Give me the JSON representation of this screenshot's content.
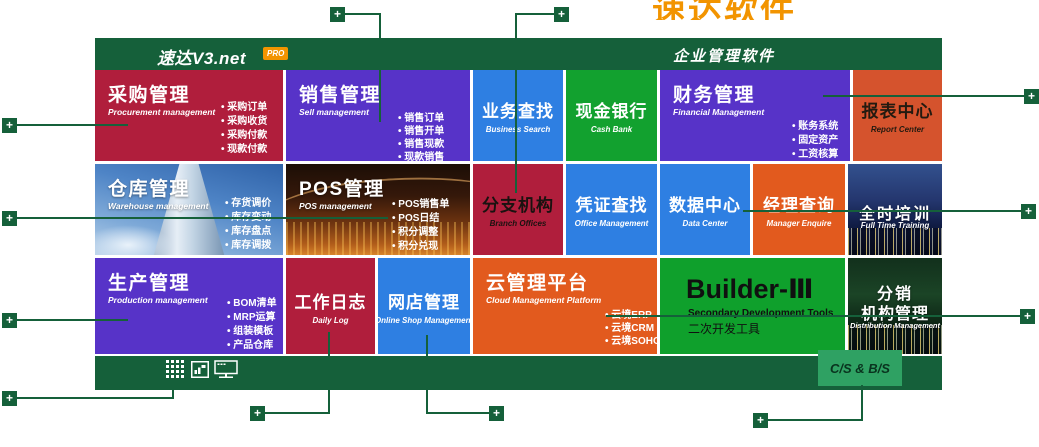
{
  "banner": {
    "cropped_text": "速达软件"
  },
  "header": {
    "brand": "速达V3.net",
    "pro_badge": "PRO",
    "product_title": "企业管理软件"
  },
  "tiles": {
    "procurement": {
      "title": "采购管理",
      "subtitle": "Procurement management",
      "items": [
        "采购订单",
        "采购收货",
        "采购付款",
        "现款付款"
      ]
    },
    "sell": {
      "title": "销售管理",
      "subtitle": "Sell management",
      "items": [
        "销售订单",
        "销售开单",
        "销售现款",
        "现款销售"
      ]
    },
    "business_search": {
      "title": "业务查找",
      "subtitle": "Business Search"
    },
    "cash_bank": {
      "title": "现金银行",
      "subtitle": "Cash Bank"
    },
    "financial": {
      "title": "财务管理",
      "subtitle": "Financial Management",
      "items": [
        "账务系统",
        "固定资产",
        "工资核算"
      ]
    },
    "report_center": {
      "title": "报表中心",
      "subtitle": "Report Center"
    },
    "warehouse": {
      "title": "仓库管理",
      "subtitle": "Warehouse management",
      "items": [
        "存货调价",
        "库存变动",
        "库存盘点",
        "库存调拨"
      ]
    },
    "pos": {
      "title": "POS管理",
      "subtitle": "POS management",
      "items": [
        "POS销售单",
        "POS日结",
        "积分调整",
        "积分兑现"
      ]
    },
    "branch": {
      "title": "分支机构",
      "subtitle": "Branch Offices"
    },
    "voucher": {
      "title": "凭证查找",
      "subtitle": "Office Management"
    },
    "data_center": {
      "title": "数据中心",
      "subtitle": "Data Center"
    },
    "manager": {
      "title": "经理查询",
      "subtitle": "Manager Enquire"
    },
    "training": {
      "title": "全时培训",
      "subtitle": "Full Time Training"
    },
    "production": {
      "title": "生产管理",
      "subtitle": "Production management",
      "items": [
        "BOM清单",
        "MRP运算",
        "组装模板",
        "产品仓库"
      ]
    },
    "daily_log": {
      "title": "工作日志",
      "subtitle": "Daily Log"
    },
    "online_shop": {
      "title": "网店管理",
      "subtitle": "Online Shop Management"
    },
    "cloud": {
      "title": "云管理平台",
      "subtitle": "Cloud Management Platform",
      "items": [
        "云境ERP",
        "云境CRM",
        "云境SOHO"
      ]
    },
    "builder": {
      "title": "Builder-Ⅲ",
      "subtitle": "Secondary Development Tools",
      "subtitle_cn": "二次开发工具"
    },
    "distribution": {
      "title_line1": "分销",
      "title_line2": "机构管理",
      "subtitle": "Distribution Management"
    }
  },
  "footer": {
    "cs_bs_label": "C/S & B/S",
    "icons": [
      "apps-grid",
      "chart-frame",
      "network-monitor"
    ]
  },
  "ui": {
    "plus": "+"
  },
  "colors": {
    "dark_green": "#15603A",
    "crimson": "#B01E3C",
    "purple": "#5733C8",
    "blue": "#2E7FE2",
    "green": "#12A12F",
    "builder_green": "#0FA02C",
    "orange": "#E25A1E",
    "red_orange": "#D5532D",
    "accent_orange": "#F29400",
    "light_green": "#2FA163"
  }
}
